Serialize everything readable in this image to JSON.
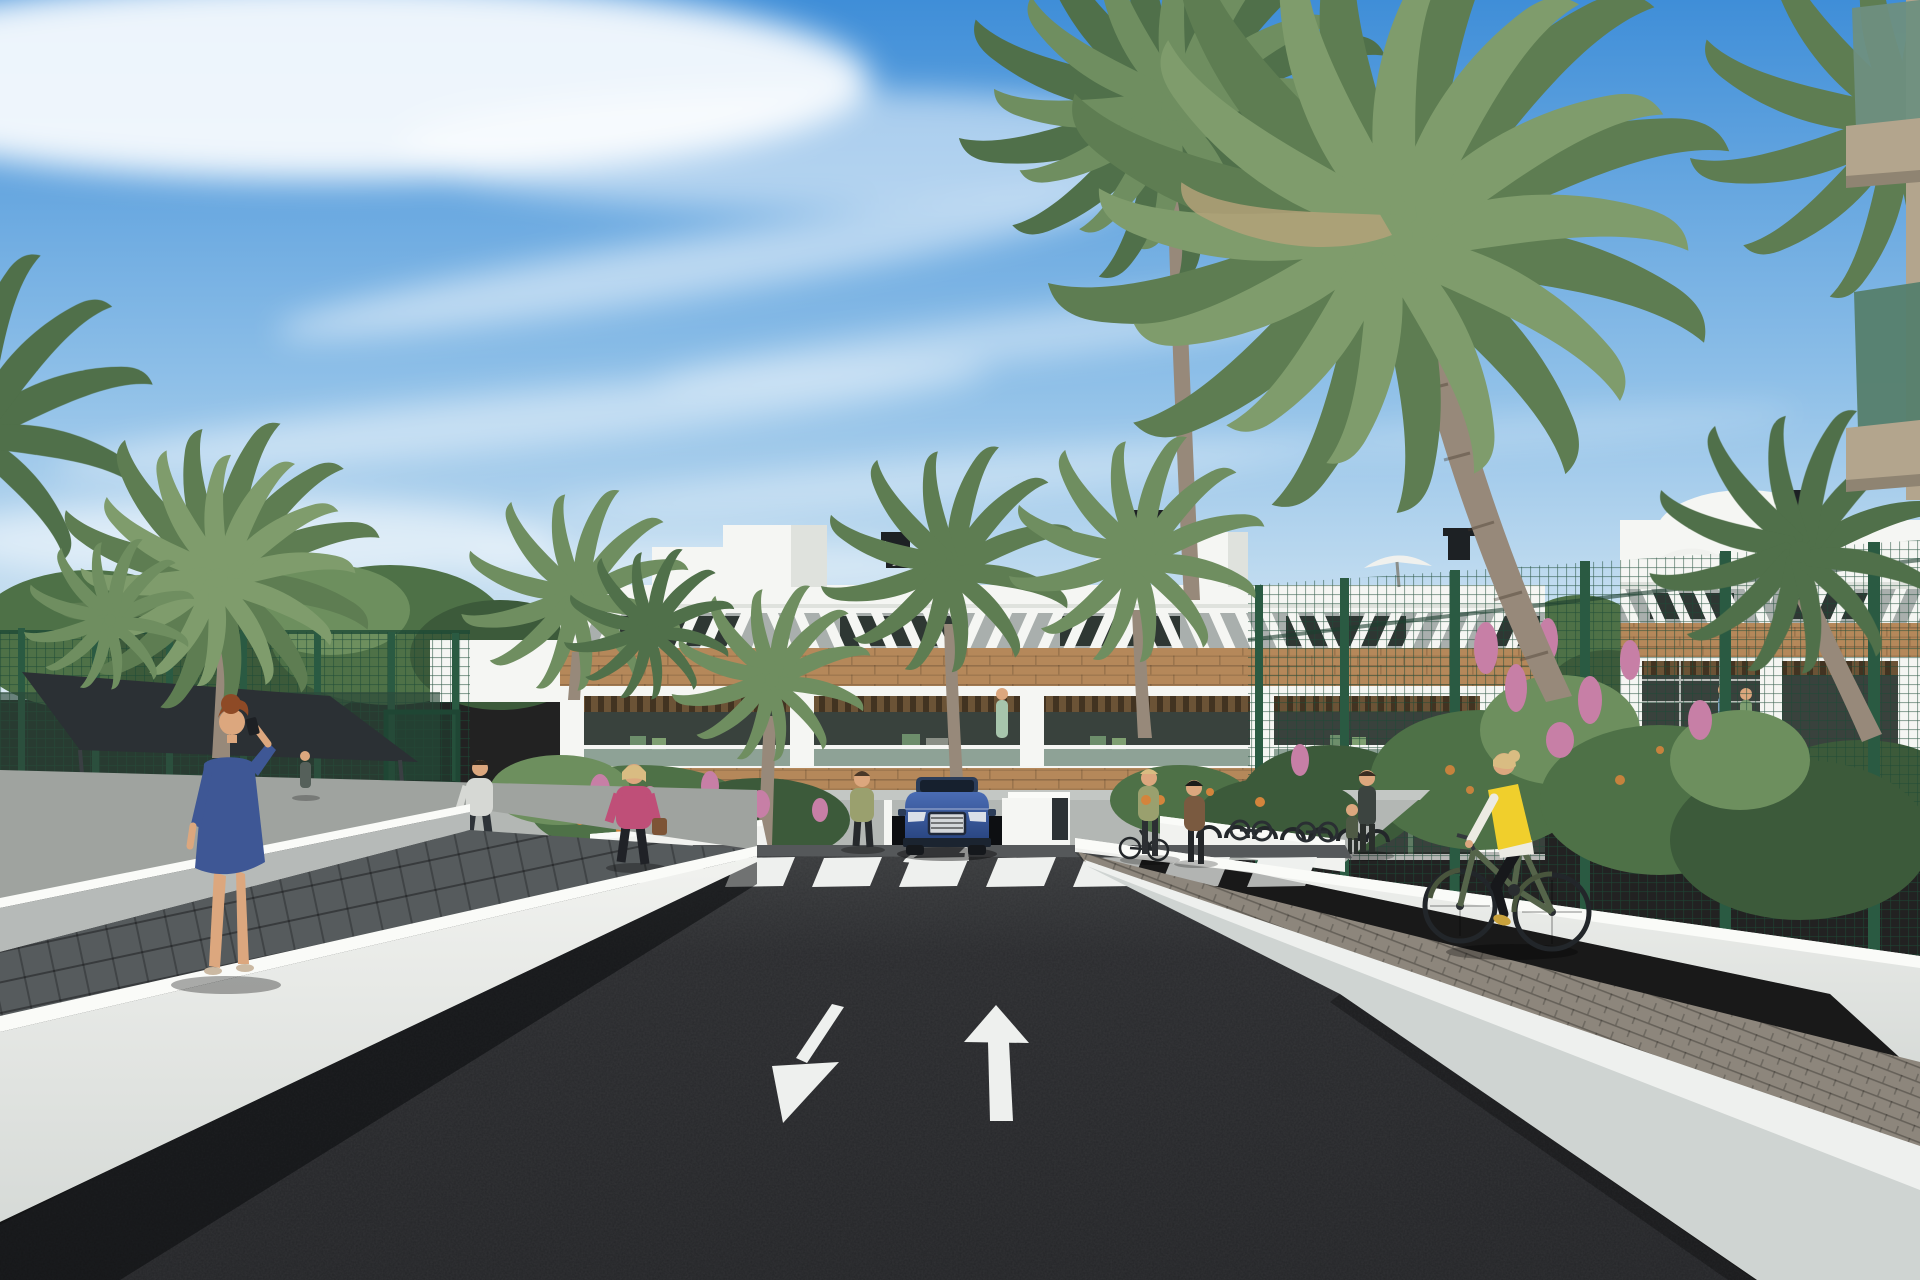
{
  "scene": {
    "type": "3d-architectural-render",
    "setting": "Sunny street view of a modern white Mediterranean apartment complex with palm trees, a two-way access road with painted lane arrows, a zebra crosswalk, a blue SUV at an underground garage ramp, pedestrians and a cyclist",
    "labels": {
      "scene": "architectural render of residential complex street",
      "sky": "blue sky with wispy clouds",
      "clouds": "wispy white clouds",
      "backgroundTrees": "background trees and shrubs",
      "leftFence": "green perimeter mesh fence",
      "tennisCourt": "dark sports court behind fence",
      "shadeCanopy": "dark shade canopy",
      "gate": "green garden gate",
      "leftWhiteBlock": "low white annex building",
      "mainBuilding": "three-storey white apartment building with wood cladding and louvred top floor",
      "rooftop": "rooftop towers, chimneys and parasols",
      "rightBuilding": "neighbouring white apartment building",
      "rightFence": "green mesh fence along right walkway",
      "flowerBushes": "flowering shrubs with pink blossoms",
      "foregroundBalconies": "glass balconies of foreground building at top right",
      "palms": "tall palm trees",
      "apron": "light concrete forecourt in front of building",
      "flowerbed": "flower bed with pink and orange blooms",
      "planters": "white planter walls",
      "kiosk": "white garage entry kiosk",
      "garage": "underground garage entrance",
      "suv": "blue SUV exiting garage ramp",
      "bikeRacks": "bicycle racks with parked bikes",
      "road": "dark asphalt access road",
      "crosswalk": "white zebra crosswalk",
      "smallArrows": "small painted arrows at ramp",
      "arrowLeft": "lane arrow pointing toward viewer",
      "arrowUp": "lane arrow pointing away",
      "rightWall": "white retaining wall on right",
      "rightSidewalk": "brick-paved right walkway",
      "nearWedge": "near white kerb wall bottom right",
      "cyclist": "woman in yellow vest riding green bicycle",
      "pedestriansRight": "pedestrians near bike racks",
      "leftTerrace": "upper left paved terrace",
      "leftWallUpper": "upper white parapet wall",
      "leftWalkway": "dark paved left walkway",
      "leftWallLower": "lower white parapet wall",
      "womanPhone": "red-haired woman in blue dress on phone",
      "manWalking": "man walking on terrace",
      "womanPink": "blonde woman in pink jacket with handbag",
      "womanOlive": "woman in olive top on forecourt",
      "familyPair": "adult with child near building",
      "terraceCouple": "couple on neighbouring terrace",
      "balconyFigure": "figure in mint dress on balcony"
    },
    "inventory": {
      "palm_trees": 10,
      "pedestrians": 9,
      "cyclists": 1,
      "vehicles": 1,
      "crosswalk_stripes": 8,
      "big_lane_arrows": 2,
      "small_ramp_arrows": 2,
      "buildings": 3
    }
  },
  "colors": {
    "skyTop": "#3f8ed8",
    "skyMid": "#8fc0e8",
    "skyLow": "#dcebf4",
    "cloud": "#ffffff",
    "treeDark": "#3c5a3a",
    "treeMid": "#4e7147",
    "treeLight": "#6d8f5e",
    "palmA": "#5e7d52",
    "palmB": "#6f8e60",
    "palmC": "#50704a",
    "palmD": "#7f9c6c",
    "palmTan": "#b7a37a",
    "trunk": "#97897a",
    "trunkDark": "#7c6f5f",
    "bldWhite": "#f5f6f3",
    "bldShade": "#dfe2dd",
    "bldGray": "#a9afad",
    "winDark": "#2e3733",
    "wood": "#b5885a",
    "woodDark": "#6b5336",
    "glassDark": "#39423d",
    "balGlass": "#9db3a6",
    "doorGreen": "#5f7b63",
    "fenceGreen": "#2a5a42",
    "meshGreen": "#1e4a36",
    "wallLit": "#f1f2ef",
    "wallMid": "#d6dad7",
    "wallDim": "#b6bab8",
    "wallShadow": "#9ca09e",
    "road": "#242528",
    "roadLight": "#55585a",
    "mark": "#eef0ee",
    "paver": "#565b5d",
    "brick": "#8d867c",
    "slab": "#cfd4d2",
    "carBlue": "#4a6cb4",
    "carBlueDark": "#27437e",
    "carDark": "#1b2430",
    "chrome": "#d4d7da",
    "canopy": "#2b3034",
    "flowerPink": "#c77fa6",
    "flowerOrange": "#d4843c",
    "skin": "#dca77e",
    "denim": "#3e5795",
    "pink": "#bf4f78",
    "yellow": "#f0cf2c",
    "whiteCloth": "#ecebe3",
    "blackCloth": "#1d2024",
    "hairRed": "#8e4a26",
    "hairBlonde": "#d9bc82",
    "olive": "#9aa06e",
    "bikeGreen": "#55644a",
    "brown": "#7a5a40",
    "mint": "#a7c5ac",
    "balconyGlassHi": "#6e8f80",
    "balconyGlassLo": "#57806d",
    "soffitTan": "#b3a58d"
  }
}
